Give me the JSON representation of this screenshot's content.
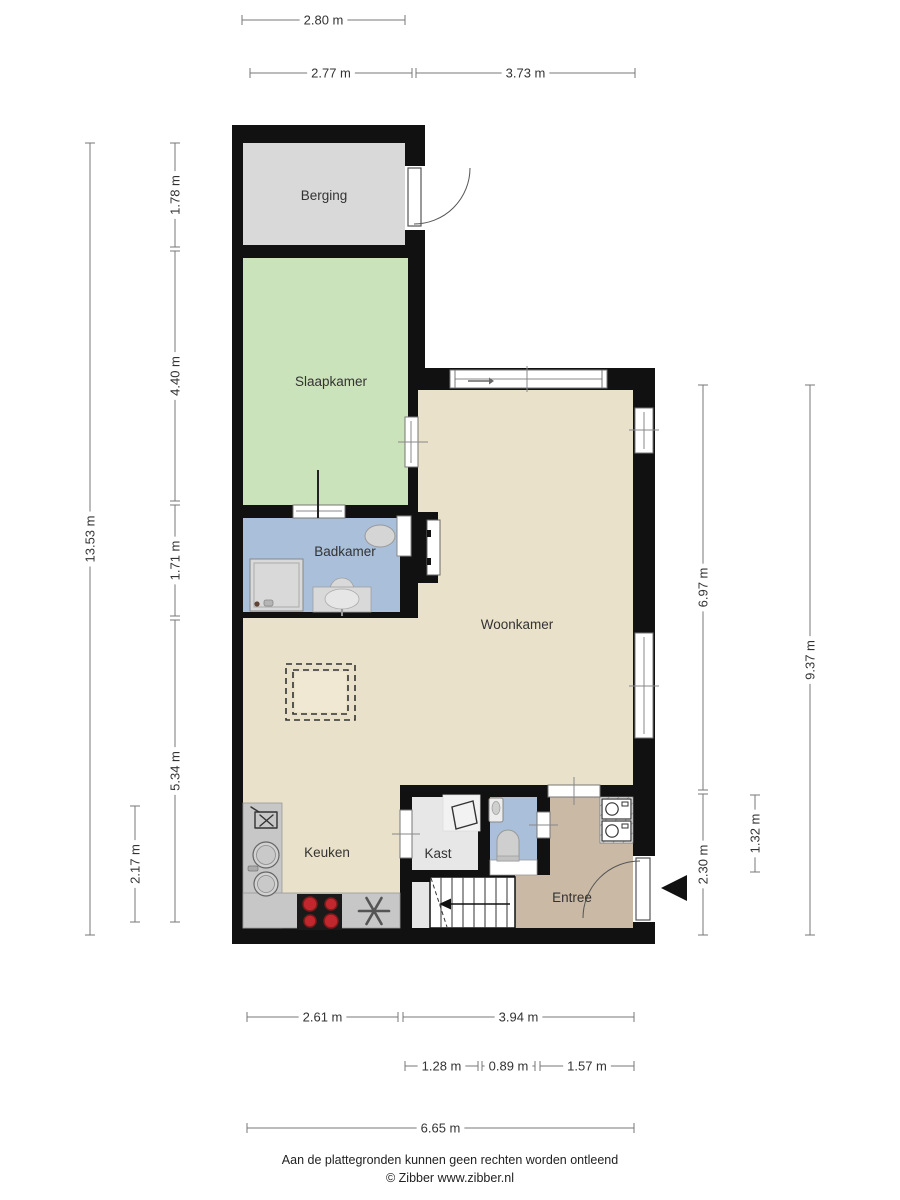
{
  "rooms": {
    "berging": "Berging",
    "slaapkamer": "Slaapkamer",
    "badkamer": "Badkamer",
    "woonkamer": "Woonkamer",
    "keuken": "Keuken",
    "kast": "Kast",
    "entree": "Entree"
  },
  "dims": {
    "top_280": "2.80 m",
    "top_277": "2.77 m",
    "top_373": "3.73 m",
    "left_1353": "13.53 m",
    "left_178": "1.78 m",
    "left_440": "4.40 m",
    "left_171": "1.71 m",
    "left_534": "5.34 m",
    "left_217": "2.17 m",
    "right_697": "6.97 m",
    "right_230": "2.30 m",
    "right_132": "1.32 m",
    "right_937": "9.37 m",
    "bottom_261": "2.61 m",
    "bottom_394": "3.94 m",
    "bottom_128": "1.28 m",
    "bottom_089": "0.89 m",
    "bottom_157": "1.57 m",
    "bottom_665": "6.65 m"
  },
  "footer": {
    "disclaimer": "Aan de plattegronden kunnen geen rechten worden ontleend",
    "credit": "© Zibber www.zibber.nl"
  },
  "icons": {
    "entrance_marker": "entrance-arrow-icon",
    "stairs_direction": "stairs-down-arrow-icon"
  },
  "colors": {
    "wall": "#111111",
    "berging_floor": "#d9d9d9",
    "slaapkamer_floor": "#cbe3ba",
    "badkamer_floor": "#a9bfda",
    "living_floor": "#eae1ca",
    "entree_floor": "#c9b9a5",
    "kast_floor": "#e7e7e7",
    "counter_gray": "#c7c7c7",
    "burner_red": "#c1272d",
    "dimension_line": "#777777"
  }
}
